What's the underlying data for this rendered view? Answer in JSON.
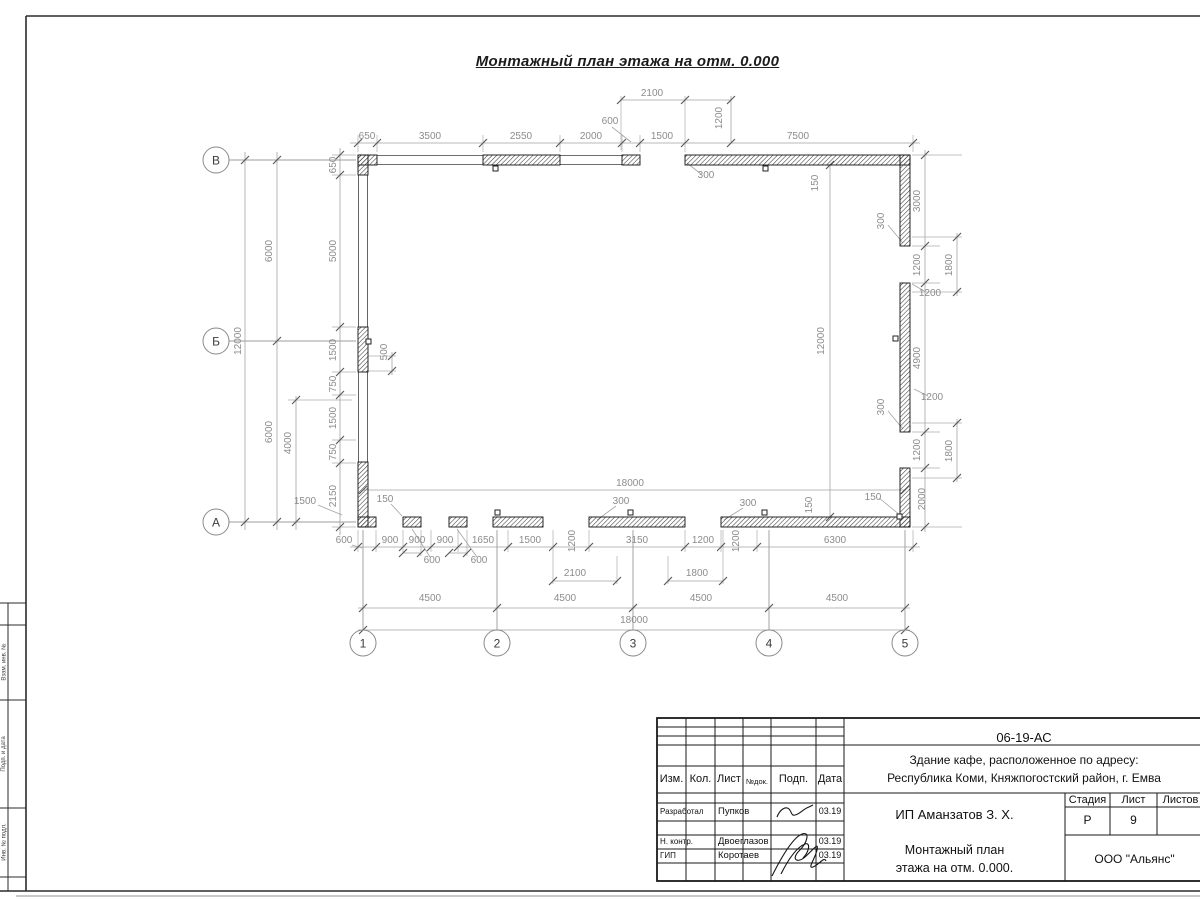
{
  "title": "Монтажный план этажа на отм. 0.000",
  "frame": {
    "margin_labels": [
      "Взам. инв. №",
      "Подп. и дата",
      "Инв. № подл."
    ]
  },
  "plan": {
    "row_axes": [
      {
        "label": "В",
        "x": 216,
        "y": 160
      },
      {
        "label": "Б",
        "x": 216,
        "y": 341
      },
      {
        "label": "А",
        "x": 216,
        "y": 522
      }
    ],
    "col_axes": [
      {
        "label": "1",
        "x": 363,
        "y": 643
      },
      {
        "label": "2",
        "x": 497,
        "y": 643
      },
      {
        "label": "3",
        "x": 633,
        "y": 643
      },
      {
        "label": "4",
        "x": 769,
        "y": 643
      },
      {
        "label": "5",
        "x": 905,
        "y": 643
      }
    ],
    "dimensions": [
      {
        "t": "650",
        "x": 367,
        "y": 139,
        "rot": false
      },
      {
        "t": "3500",
        "x": 430,
        "y": 139,
        "rot": false
      },
      {
        "t": "2550",
        "x": 521,
        "y": 139,
        "rot": false
      },
      {
        "t": "2000",
        "x": 591,
        "y": 139,
        "rot": false
      },
      {
        "t": "600",
        "x": 610,
        "y": 124,
        "rot": false
      },
      {
        "t": "1500",
        "x": 662,
        "y": 139,
        "rot": false
      },
      {
        "t": "7500",
        "x": 798,
        "y": 139,
        "rot": false
      },
      {
        "t": "2100",
        "x": 652,
        "y": 96,
        "rot": false
      },
      {
        "t": "1200",
        "x": 722,
        "y": 118,
        "rot": true
      },
      {
        "t": "300",
        "x": 706,
        "y": 178,
        "rot": false
      },
      {
        "t": "150",
        "x": 818,
        "y": 183,
        "rot": true
      },
      {
        "t": "12000",
        "x": 241,
        "y": 341,
        "rot": true
      },
      {
        "t": "6000",
        "x": 272,
        "y": 251,
        "rot": true
      },
      {
        "t": "6000",
        "x": 272,
        "y": 432,
        "rot": true
      },
      {
        "t": "4000",
        "x": 291,
        "y": 443,
        "rot": true
      },
      {
        "t": "650",
        "x": 336,
        "y": 165,
        "rot": true
      },
      {
        "t": "5000",
        "x": 336,
        "y": 251,
        "rot": true
      },
      {
        "t": "1500",
        "x": 336,
        "y": 350,
        "rot": true
      },
      {
        "t": "750",
        "x": 336,
        "y": 384,
        "rot": true
      },
      {
        "t": "1500",
        "x": 336,
        "y": 418,
        "rot": true
      },
      {
        "t": "750",
        "x": 336,
        "y": 452,
        "rot": true
      },
      {
        "t": "2150",
        "x": 336,
        "y": 496,
        "rot": true
      },
      {
        "t": "500",
        "x": 387,
        "y": 352,
        "rot": true
      },
      {
        "t": "1500",
        "x": 305,
        "y": 504,
        "rot": false
      },
      {
        "t": "3000",
        "x": 920,
        "y": 201,
        "rot": true
      },
      {
        "t": "1200",
        "x": 920,
        "y": 265,
        "rot": true
      },
      {
        "t": "4900",
        "x": 920,
        "y": 358,
        "rot": true
      },
      {
        "t": "1200",
        "x": 920,
        "y": 450,
        "rot": true
      },
      {
        "t": "2000",
        "x": 925,
        "y": 499,
        "rot": true
      },
      {
        "t": "1800",
        "x": 952,
        "y": 265,
        "rot": true
      },
      {
        "t": "1800",
        "x": 952,
        "y": 451,
        "rot": true
      },
      {
        "t": "1200",
        "x": 930,
        "y": 296,
        "rot": false
      },
      {
        "t": "1200",
        "x": 932,
        "y": 400,
        "rot": false
      },
      {
        "t": "300",
        "x": 884,
        "y": 221,
        "rot": true
      },
      {
        "t": "300",
        "x": 884,
        "y": 407,
        "rot": true
      },
      {
        "t": "150",
        "x": 873,
        "y": 500,
        "rot": false
      },
      {
        "t": "600",
        "x": 344,
        "y": 543,
        "rot": false
      },
      {
        "t": "900",
        "x": 390,
        "y": 543,
        "rot": false
      },
      {
        "t": "900",
        "x": 417,
        "y": 543,
        "rot": false
      },
      {
        "t": "900",
        "x": 445,
        "y": 543,
        "rot": false
      },
      {
        "t": "1650",
        "x": 483,
        "y": 543,
        "rot": false
      },
      {
        "t": "1500",
        "x": 530,
        "y": 543,
        "rot": false
      },
      {
        "t": "1200",
        "x": 575,
        "y": 541,
        "rot": true
      },
      {
        "t": "3150",
        "x": 637,
        "y": 543,
        "rot": false
      },
      {
        "t": "1200",
        "x": 703,
        "y": 543,
        "rot": false
      },
      {
        "t": "1200",
        "x": 739,
        "y": 541,
        "rot": true
      },
      {
        "t": "6300",
        "x": 835,
        "y": 543,
        "rot": false
      },
      {
        "t": "600",
        "x": 432,
        "y": 563,
        "rot": false
      },
      {
        "t": "600",
        "x": 479,
        "y": 563,
        "rot": false
      },
      {
        "t": "2100",
        "x": 575,
        "y": 576,
        "rot": false
      },
      {
        "t": "1800",
        "x": 697,
        "y": 576,
        "rot": false
      },
      {
        "t": "300",
        "x": 621,
        "y": 504,
        "rot": false
      },
      {
        "t": "300",
        "x": 748,
        "y": 506,
        "rot": false
      },
      {
        "t": "150",
        "x": 385,
        "y": 502,
        "rot": false
      },
      {
        "t": "150",
        "x": 812,
        "y": 505,
        "rot": true
      },
      {
        "t": "4500",
        "x": 430,
        "y": 601,
        "rot": false
      },
      {
        "t": "4500",
        "x": 565,
        "y": 601,
        "rot": false
      },
      {
        "t": "4500",
        "x": 701,
        "y": 601,
        "rot": false
      },
      {
        "t": "4500",
        "x": 837,
        "y": 601,
        "rot": false
      },
      {
        "t": "18000",
        "x": 634,
        "y": 623,
        "rot": false
      },
      {
        "t": "18000",
        "x": 630,
        "y": 486,
        "rot": false
      },
      {
        "t": "12000",
        "x": 824,
        "y": 341,
        "rot": true
      }
    ]
  },
  "stamp": {
    "doc_number": "06-19-АС",
    "object_line1": "Здание кафе, расположенное по адресу:",
    "object_line2": "Республика Коми, Княжпогостский район, г. Емва",
    "client": "ИП Аманзатов З. Х.",
    "sheet_title_line1": "Монтажный план",
    "sheet_title_line2": "этажа на отм. 0.000.",
    "company": "ООО \"Альянс\"",
    "stage_label": "Стадия",
    "stage_value": "Р",
    "sheet_label": "Лист",
    "sheet_value": "9",
    "sheets_label": "Листов",
    "sheets_value": "",
    "header_cols": [
      "Изм.",
      "Кол.",
      "Лист",
      "№док.",
      "Подп.",
      "Дата"
    ],
    "rows": [
      {
        "role": "Разработал",
        "name": "Пупков",
        "date": "03.19"
      },
      {
        "role": "Н. контр.",
        "name": "Двоеглазов",
        "date": "03.19"
      },
      {
        "role": "ГИП",
        "name": "Коротаев",
        "date": "03.19"
      }
    ]
  }
}
